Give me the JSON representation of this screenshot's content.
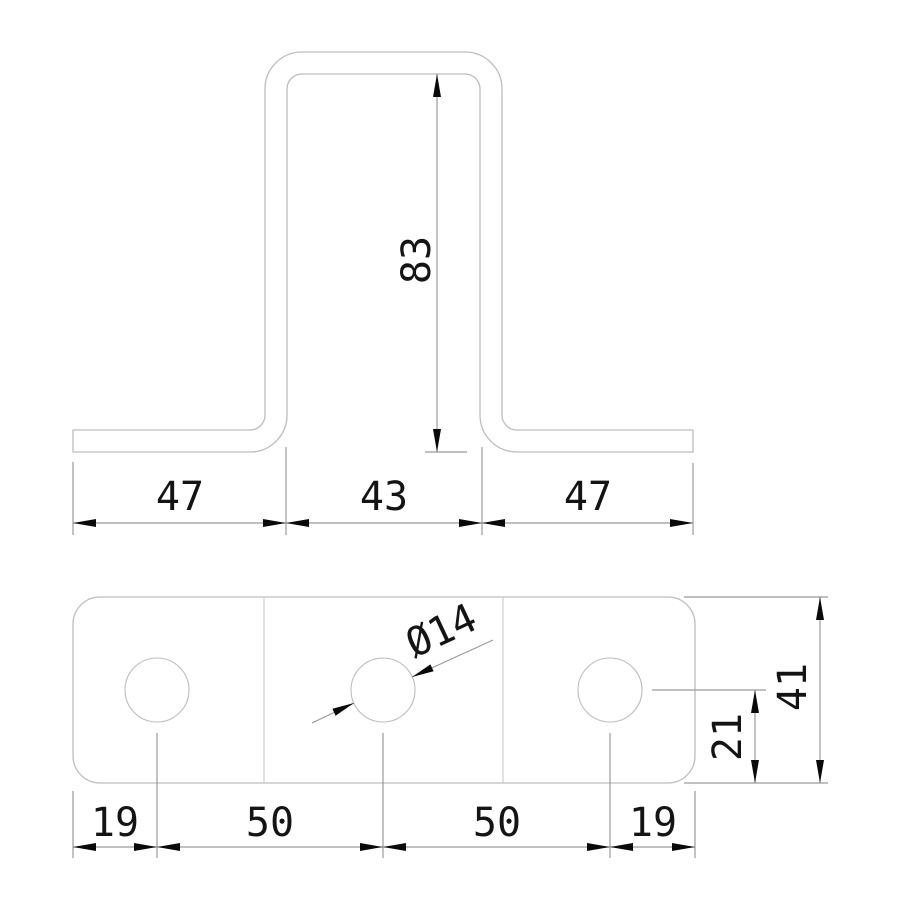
{
  "drawing": {
    "type": "technical-drawing",
    "part": "hat-channel bracket, two orthographic views",
    "colors": {
      "background": "#ffffff",
      "part_outline": "#bdbdbd",
      "bend_line": "#c8c8c8",
      "dimension_line": "#9b9b9b",
      "arrow_and_text": "#141414"
    },
    "front_view": {
      "description": "hat profile cross-section",
      "dim_left_flange": "47",
      "dim_web_width": "43",
      "dim_right_flange": "47",
      "dim_height": "83"
    },
    "plan_view": {
      "description": "flat plate with three holes and two bend lines",
      "dim_edge_to_hole_left": "19",
      "dim_hole_pitch_left": "50",
      "dim_hole_pitch_right": "50",
      "dim_hole_to_edge_right": "19",
      "dim_hole_diameter": "Ø14",
      "dim_hole_center_offset": "21",
      "dim_plate_width": "41",
      "hole_count": 3
    }
  }
}
